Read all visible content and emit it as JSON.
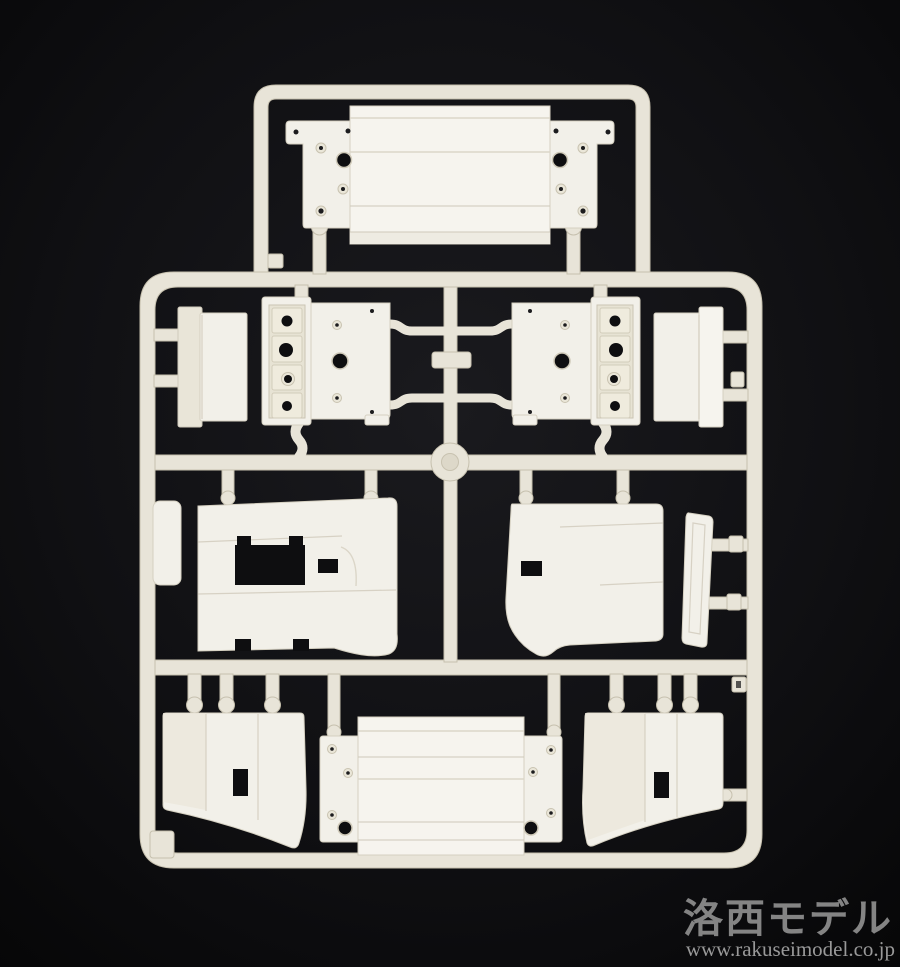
{
  "scene": {
    "type": "photograph",
    "subject": "white injection-molded plastic model kit sprue (runner) laid on a black background"
  },
  "watermark": {
    "brand": "洛西モデル",
    "url": "www.rakuseimodel.co.jp"
  },
  "colors": {
    "background": "#0c0c0e",
    "plastic": "#e8e4d8",
    "plastic_bright": "#f4f2ec",
    "plastic_shadow": "#d9d4c5",
    "hole": "#0e0e10",
    "watermark_brand": "#8f8f8f",
    "watermark_url": "#a9a9a9"
  },
  "parts": [
    {
      "id": "roof-plate-top"
    },
    {
      "id": "box-upper-left"
    },
    {
      "id": "bracket-plate-left"
    },
    {
      "id": "bracket-plate-right"
    },
    {
      "id": "box-upper-right"
    },
    {
      "id": "small-plate-left-rail"
    },
    {
      "id": "side-panel-left"
    },
    {
      "id": "side-panel-right"
    },
    {
      "id": "wind-deflector-right"
    },
    {
      "id": "lower-panel-left"
    },
    {
      "id": "floor-plate-bottom"
    },
    {
      "id": "lower-panel-right"
    }
  ]
}
